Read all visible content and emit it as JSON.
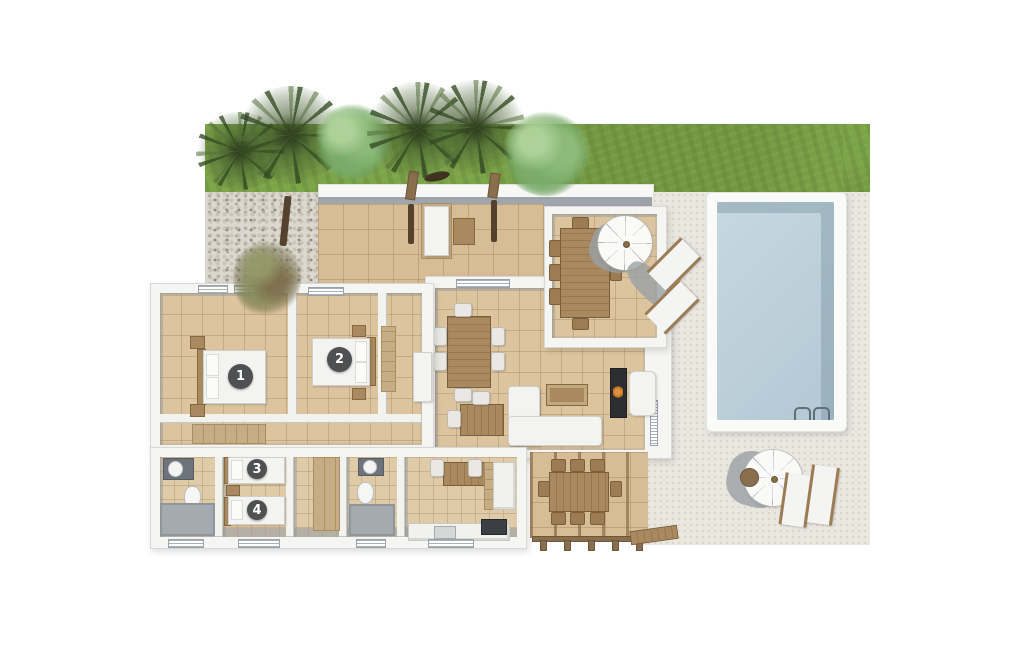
{
  "scene": {
    "description": "3D top-down architectural floor plan of a villa with tropical garden, pebble path, roofed entry terrace, interior rooms, pergola dining areas, sun deck and swimming pool",
    "background_color": "#ffffff"
  },
  "palette": {
    "grass": "#7ca449",
    "pebbles": "#dbd8cf",
    "deck": "#eae7e1",
    "interior_tile": "#dcc49f",
    "terrace_tile": "#d7bd96",
    "wall": "#f5f5f3",
    "wall_shadow": "#8f979d",
    "pool_water": "#bed1db",
    "pool_coping": "#fafaf9",
    "wood": "#a9895f",
    "white_furniture": "#f3f3f1",
    "marker_background": "#4f5052",
    "marker_text": "#ffffff"
  },
  "markers": [
    {
      "label": "1"
    },
    {
      "label": "2"
    },
    {
      "label": "3"
    },
    {
      "label": "4"
    }
  ]
}
